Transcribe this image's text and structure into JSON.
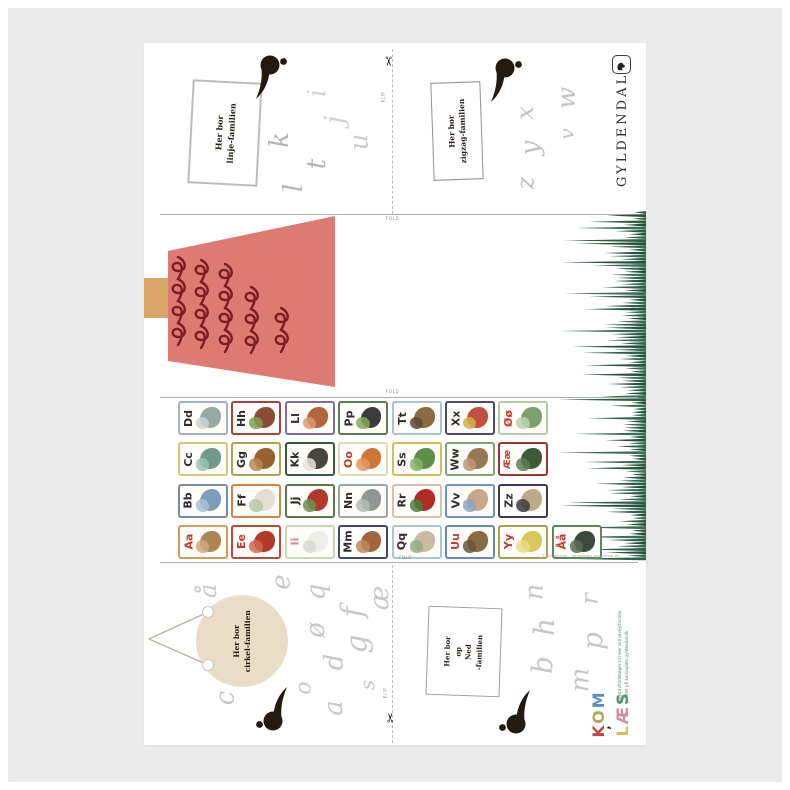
{
  "publisher": {
    "name": "GYLDENDAL"
  },
  "labels": {
    "fold": "FOLD",
    "klip": "KLIP"
  },
  "families": {
    "linje": {
      "label": [
        "Her bor",
        "linje-familien"
      ],
      "letters": [
        {
          "ch": "i",
          "x": 169,
          "y": 38,
          "s": 24,
          "c": "#d0d0d0"
        },
        {
          "ch": "j",
          "x": 187,
          "y": 64,
          "s": 26,
          "c": "#d0d0d0"
        },
        {
          "ch": "u",
          "x": 207,
          "y": 86,
          "s": 26,
          "c": "#cccccc"
        },
        {
          "ch": "k",
          "x": 128,
          "y": 84,
          "s": 26,
          "c": "#b5b5b5"
        },
        {
          "ch": "t",
          "x": 168,
          "y": 108,
          "s": 26,
          "c": "#b5b5b5"
        },
        {
          "ch": "l",
          "x": 146,
          "y": 132,
          "s": 26,
          "c": "#b5b5b5"
        }
      ]
    },
    "zigzag": {
      "label": [
        "Her bor",
        "zigzag-familien"
      ],
      "letters": [
        {
          "ch": "w",
          "x": 412,
          "y": 42,
          "s": 26,
          "c": "#c3c3c3"
        },
        {
          "ch": "x",
          "x": 374,
          "y": 58,
          "s": 24,
          "c": "#c3c3c3"
        },
        {
          "ch": "v",
          "x": 417,
          "y": 81,
          "s": 20,
          "c": "#c3c3c3"
        },
        {
          "ch": "y",
          "x": 379,
          "y": 92,
          "s": 26,
          "c": "#c3c3c3"
        },
        {
          "ch": "z",
          "x": 375,
          "y": 128,
          "s": 24,
          "c": "#c3c3c3"
        }
      ]
    },
    "cirkel": {
      "label": [
        "Her bor",
        "cirkel-familien"
      ],
      "letters": [
        {
          "ch": "å",
          "x": 57,
          "y": 536,
          "s": 24,
          "c": "#c8c8c8"
        },
        {
          "ch": "e",
          "x": 130,
          "y": 526,
          "s": 26,
          "c": "#c8c8c8"
        },
        {
          "ch": "q",
          "x": 164,
          "y": 536,
          "s": 26,
          "c": "#c8c8c8"
        },
        {
          "ch": "æ",
          "x": 224,
          "y": 542,
          "s": 26,
          "c": "#c8c8c8"
        },
        {
          "ch": "f",
          "x": 204,
          "y": 554,
          "s": 30,
          "c": "#c8c8c8"
        },
        {
          "ch": "ø",
          "x": 164,
          "y": 574,
          "s": 26,
          "c": "#c8c8c8"
        },
        {
          "ch": "g",
          "x": 204,
          "y": 586,
          "s": 30,
          "c": "#c8c8c8"
        },
        {
          "ch": "d",
          "x": 182,
          "y": 606,
          "s": 26,
          "c": "#c8c8c8"
        },
        {
          "ch": "o",
          "x": 154,
          "y": 634,
          "s": 22,
          "c": "#c8c8c8"
        },
        {
          "ch": "c",
          "x": 74,
          "y": 642,
          "s": 26,
          "c": "#c8c8c8"
        },
        {
          "ch": "a",
          "x": 182,
          "y": 652,
          "s": 26,
          "c": "#c8c8c8"
        },
        {
          "ch": "s",
          "x": 218,
          "y": 632,
          "s": 20,
          "c": "#c8c8c8"
        }
      ]
    },
    "opned": {
      "label": [
        "Her bor",
        "op",
        "Ned",
        "-familien"
      ],
      "letters": [
        {
          "ch": "n",
          "x": 382,
          "y": 536,
          "s": 26,
          "c": "#c8c8c8"
        },
        {
          "ch": "r",
          "x": 440,
          "y": 544,
          "s": 24,
          "c": "#c8c8c8"
        },
        {
          "ch": "h",
          "x": 392,
          "y": 570,
          "s": 28,
          "c": "#c8c8c8"
        },
        {
          "ch": "p",
          "x": 440,
          "y": 584,
          "s": 28,
          "c": "#c8c8c8"
        },
        {
          "ch": "b",
          "x": 390,
          "y": 608,
          "s": 28,
          "c": "#c8c8c8"
        },
        {
          "ch": "m",
          "x": 424,
          "y": 624,
          "s": 26,
          "c": "#c8c8c8"
        }
      ]
    }
  },
  "alphabet": {
    "vowel_color": "#c23b30",
    "consonant_color": "#2e2e2e",
    "rows": [
      [
        {
          "pair": "Dd",
          "border": "#9fb3c4",
          "lc": "c",
          "ill": [
            "#98a8a2",
            "#c7d6d2"
          ],
          "name": "dolphin"
        },
        {
          "pair": "Hh",
          "border": "#a3453a",
          "lc": "c",
          "ill": [
            "#8d4a35",
            "#7f9e57"
          ],
          "name": "house"
        },
        {
          "pair": "Ll",
          "border": "#7d6da2",
          "lc": "c",
          "ill": [
            "#b5653f",
            "#d79a6b"
          ],
          "name": "pastry"
        },
        {
          "pair": "Pp",
          "border": "#5c7d53",
          "lc": "c",
          "ill": [
            "#3b3b3b",
            "#86a85f"
          ],
          "name": "panda"
        },
        {
          "pair": "Tt",
          "border": "#a9c4d4",
          "lc": "c",
          "ill": [
            "#8a6b42",
            "#5c4a33"
          ],
          "name": "toad"
        },
        {
          "pair": "Xx",
          "border": "#4d4a72",
          "lc": "c",
          "ill": [
            "#c05040",
            "#d8b048"
          ],
          "name": "xylophone"
        },
        {
          "pair": "Øø",
          "border": "#b5cba4",
          "lc": "v",
          "ill": [
            "#7fa06a",
            "#b9d3ae"
          ],
          "name": "island"
        }
      ],
      [
        {
          "pair": "Cc",
          "border": "#d6c47a",
          "lc": "c",
          "ill": [
            "#6f9a8c",
            "#9cc0b4"
          ],
          "name": "bicycle"
        },
        {
          "pair": "Gg",
          "border": "#aaa355",
          "lc": "c",
          "ill": [
            "#96602f",
            "#b98a55"
          ],
          "name": "guitar"
        },
        {
          "pair": "Kk",
          "border": "#39593f",
          "lc": "c",
          "ill": [
            "#4a463f",
            "#e8e4da"
          ],
          "name": "cow"
        },
        {
          "pair": "Oo",
          "border": "#e3d9b5",
          "lc": "v",
          "ill": [
            "#d0763a",
            "#e09a62"
          ],
          "name": "worm"
        },
        {
          "pair": "Ss",
          "border": "#d4bd5e",
          "lc": "c",
          "ill": [
            "#5f8f46",
            "#86b36a"
          ],
          "name": "snake"
        },
        {
          "pair": "Ww",
          "border": "#85a276",
          "lc": "c",
          "ill": [
            "#977754",
            "#b99a76"
          ],
          "name": "wombat"
        },
        {
          "pair": "Ææ",
          "border": "#9e352c",
          "lc": "v",
          "ill": [
            "#3e5b39",
            "#5d7d55"
          ],
          "name": "donkey"
        }
      ],
      [
        {
          "pair": "Bb",
          "border": "#7a8aa8",
          "lc": "c",
          "ill": [
            "#7d9cba",
            "#a9c2d8"
          ],
          "name": "whale"
        },
        {
          "pair": "Ff",
          "border": "#d08446",
          "lc": "c",
          "ill": [
            "#e4ddd0",
            "#b9c9a4"
          ],
          "name": "sheep"
        },
        {
          "pair": "Jj",
          "border": "#5a7a4e",
          "lc": "c",
          "ill": [
            "#b23a2c",
            "#6b9350"
          ],
          "name": "strawberry"
        },
        {
          "pair": "Nn",
          "border": "#9aa9a2",
          "lc": "c",
          "ill": [
            "#8f9693",
            "#b4bcb9"
          ],
          "name": "rhino"
        },
        {
          "pair": "Rr",
          "border": "#d8bfa8",
          "lc": "c",
          "ill": [
            "#b02a28",
            "#4f7c3c"
          ],
          "name": "rose"
        },
        {
          "pair": "Vv",
          "border": "#7090c0",
          "lc": "c",
          "ill": [
            "#c9a88a",
            "#8aa7c4"
          ],
          "name": "child"
        },
        {
          "pair": "Zz",
          "border": "#3c3c58",
          "lc": "c",
          "ill": [
            "#bca98a",
            "#3c3c3c"
          ],
          "name": "zebra"
        }
      ],
      [
        {
          "pair": "Aa",
          "border": "#d49a5c",
          "lc": "v",
          "ill": [
            "#ad8456",
            "#d0aa7c"
          ],
          "name": "monkey"
        },
        {
          "pair": "Ee",
          "border": "#c04838",
          "lc": "v",
          "ill": [
            "#b23a28",
            "#d06a50"
          ],
          "name": "squirrel"
        },
        {
          "pair": "Ii",
          "border": "#c9d9b5",
          "lc": "i",
          "ill": [
            "#eceee6",
            "#d4dcd0"
          ],
          "name": "igloo"
        },
        {
          "pair": "Mm",
          "border": "#3c4a6a",
          "lc": "c",
          "ill": [
            "#a0653c",
            "#c08a5c"
          ],
          "name": "mouse"
        },
        {
          "pair": "Qq",
          "border": "#a9c6d6",
          "lc": "c",
          "ill": [
            "#cbb9a2",
            "#8fae86"
          ],
          "name": "figure"
        },
        {
          "pair": "Uu",
          "border": "#6888b8",
          "lc": "v",
          "ill": [
            "#8a6a46",
            "#6d5438"
          ],
          "name": "owl"
        },
        {
          "pair": "Yy",
          "border": "#a8a050",
          "lc": "v",
          "ill": [
            "#d8c85c",
            "#e8dc8c"
          ],
          "name": "yoghurt"
        },
        {
          "pair": "Åå",
          "border": "#5a8a5a",
          "lc": "v",
          "ill": [
            "#3a4a3c",
            "#5c6e58"
          ],
          "name": "eel"
        }
      ]
    ]
  },
  "logo": {
    "kom": [
      [
        "K",
        "#c24840"
      ],
      [
        "O",
        "#aeac58"
      ],
      [
        "M",
        "#5b8fc9"
      ]
    ],
    "laes": [
      [
        "L",
        "#d9c25a"
      ],
      [
        "Æ",
        "#d98a9e"
      ],
      [
        "S",
        "#4a9b6e"
      ]
    ],
    "connector": ","
  },
  "fine_print": {
    "green_line1": "Bogstavfoldebøger til hver skrivevejsfamilie",
    "green_line2": "printes på komoglæs.gyldendal.dk",
    "credit": "© Gyldendal · komoglæs.gyldendal.dk"
  },
  "artwork": {
    "tree_body": "#dd7a72",
    "tree_trunk": "#d9a566",
    "tree_curl": "#7a1e22",
    "grass_colors": [
      "#2d5f47",
      "#24523c",
      "#3a6d52"
    ],
    "comma_color": "#231a10",
    "circle_fill": "#e9ddc5"
  }
}
